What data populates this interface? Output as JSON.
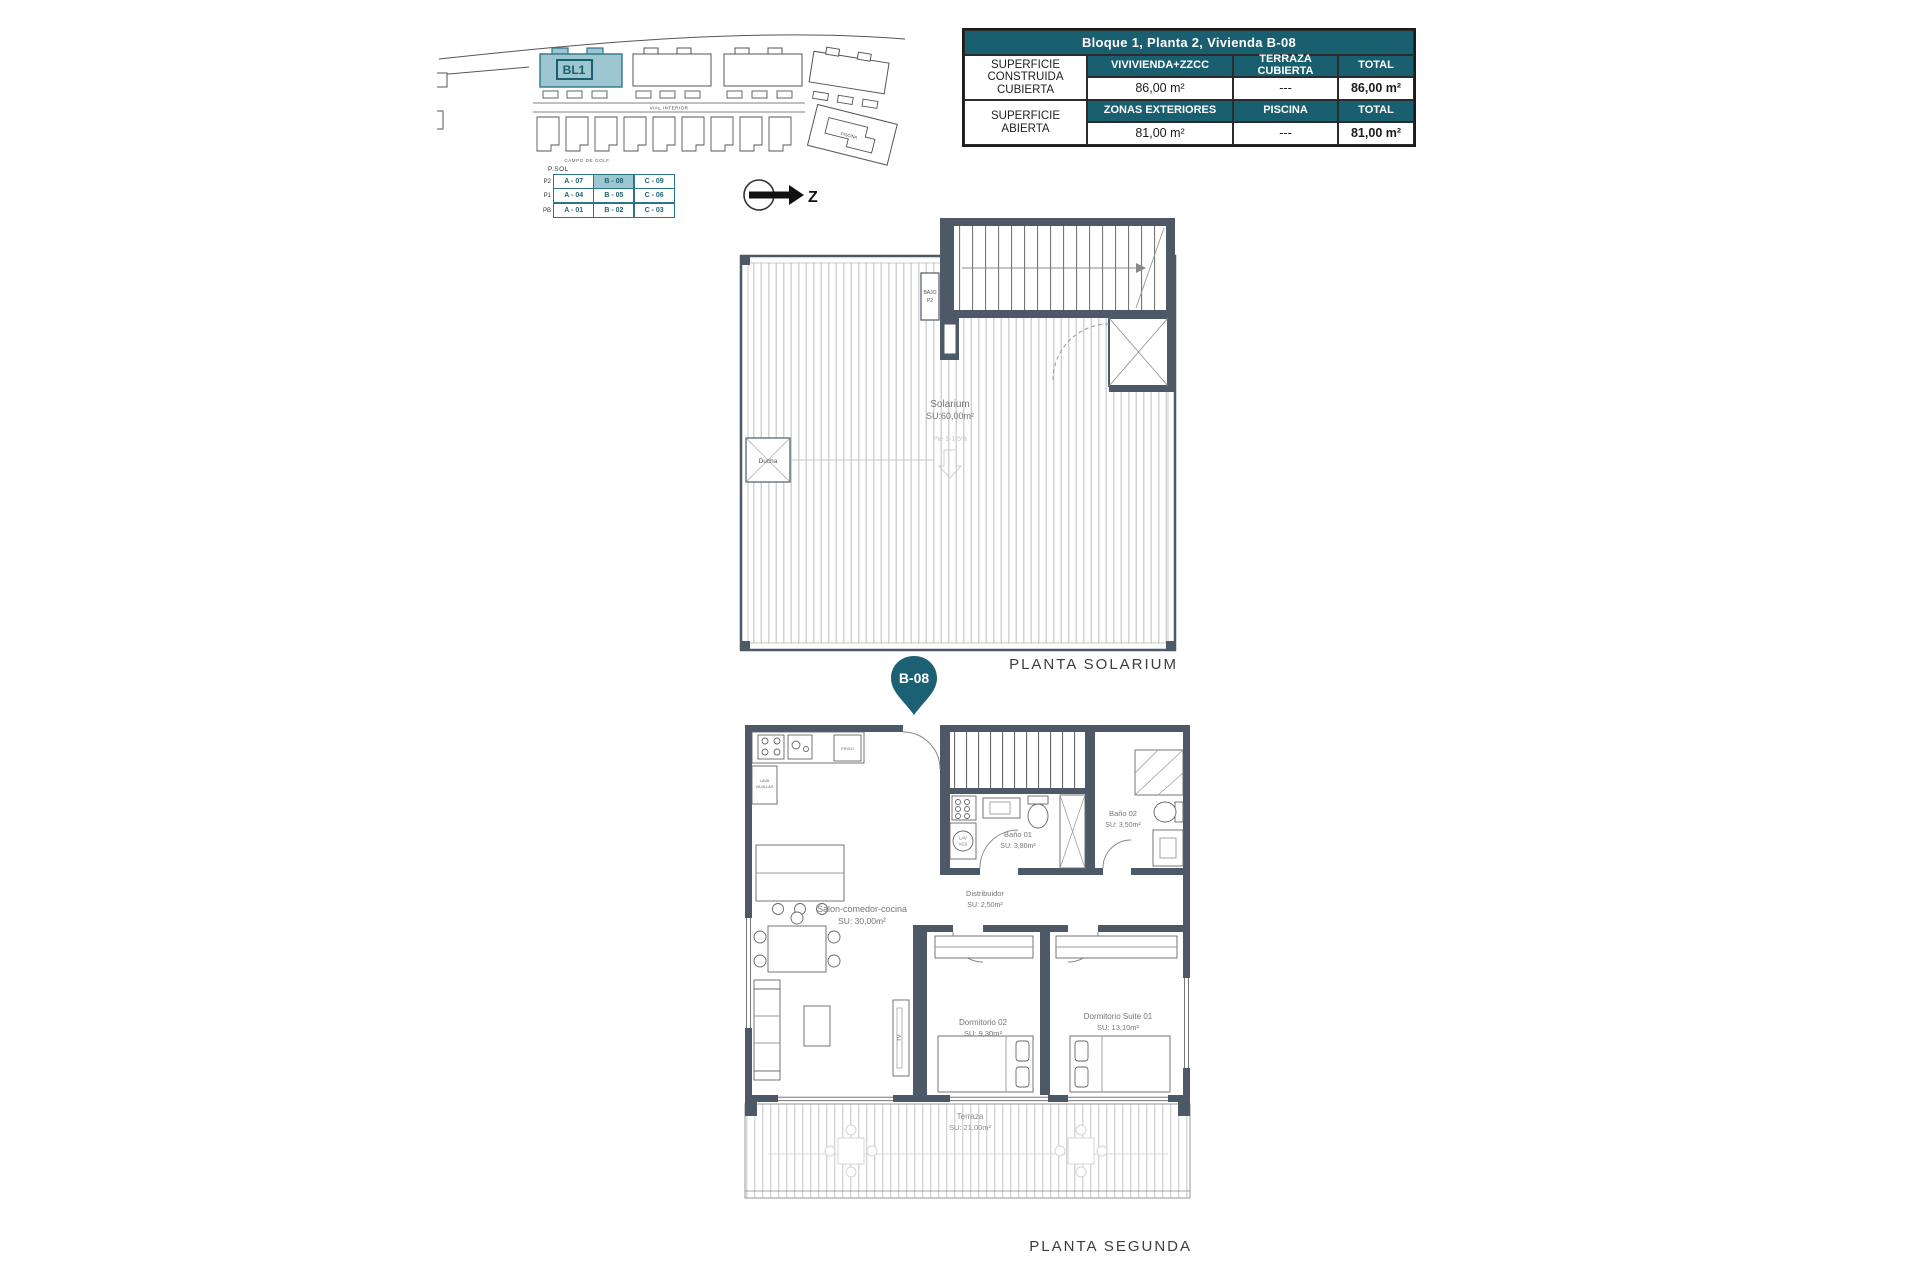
{
  "colors": {
    "teal": "#1A5F6F",
    "teal_light": "#9CC6D0",
    "wall": "#4D5966"
  },
  "site_plan": {
    "block_label": "BL1",
    "street_label": "VIAL INTERIOR",
    "golf_label": "CAMPO DE GOLF",
    "pool_label": "PISCINA",
    "north_letter": "Z"
  },
  "unit_matrix": {
    "top_label": "P.SOL",
    "rows": [
      {
        "floor": "P2",
        "cells": [
          "A - 07",
          "B - 08",
          "C - 09"
        ]
      },
      {
        "floor": "P1",
        "cells": [
          "A - 04",
          "B - 05",
          "C - 06"
        ]
      },
      {
        "floor": "PB",
        "cells": [
          "A - 01",
          "B - 02",
          "C - 03"
        ]
      }
    ],
    "highlighted_unit": "B - 08"
  },
  "info_table": {
    "title": "Bloque 1, Planta 2, Vivienda B-08",
    "row1_label": "SUPERFICIE CONSTRUIDA CUBIERTA",
    "row1_headers": [
      "VIVIVIENDA+ZZCC",
      "TERRAZA CUBIERTA",
      "TOTAL"
    ],
    "row1_values": [
      "86,00 m²",
      "---",
      "86,00 m²"
    ],
    "row2_label": "SUPERFICIE ABIERTA",
    "row2_headers": [
      "ZONAS EXTERIORES",
      "PISCINA",
      "TOTAL"
    ],
    "row2_values": [
      "81,00 m²",
      "---",
      "81,00 m²"
    ]
  },
  "solarium": {
    "title": "PLANTA SOLARIUM",
    "room": "Solarium",
    "room_area": "SU:60,00m²",
    "shower": "Ducha",
    "stair_box_line1": "BAJO",
    "stair_box_line2": "P2",
    "slope": "Pte 1-1.5%"
  },
  "segunda": {
    "title": "PLANTA SEGUNDA",
    "pin": "B-08",
    "salon": {
      "name": "Salon-comedor-cocina",
      "area": "SU: 30,00m²"
    },
    "distribuidor": {
      "name": "Distribuidor",
      "area": "SU: 2,50m²"
    },
    "bano1": {
      "name": "Baño 01",
      "area": "SU: 3,80m²"
    },
    "bano2": {
      "name": "Baño 02",
      "area": "SU: 3,50m²"
    },
    "dorm2": {
      "name": "Dormitorio 02",
      "area": "SU: 9,30m²"
    },
    "suite": {
      "name": "Dormitorio Suite 01",
      "area": "SU: 13,10m²"
    },
    "terraza": {
      "name": "Terraza",
      "area": "SU: 21,00m²"
    },
    "tv": "TV",
    "lav_line1": "LAV",
    "lav_line2": "ACS",
    "frigo": "FRIGO",
    "lavavajillas_line1": "LAVA",
    "lavavajillas_line2": "VAJILLAS"
  }
}
